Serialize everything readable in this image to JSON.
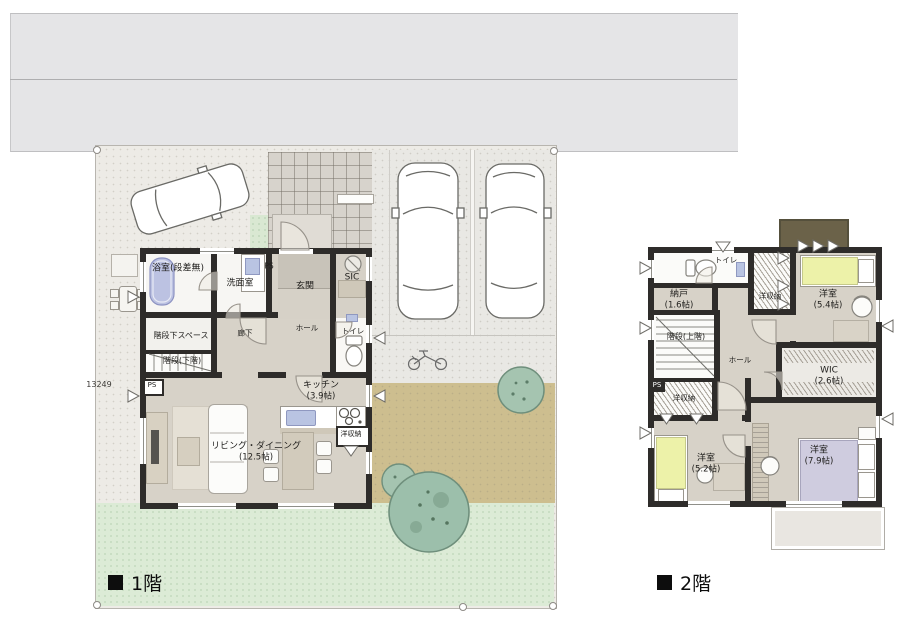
{
  "captions": {
    "floor1": "1階",
    "floor2": "2階"
  },
  "dimension": "13249",
  "f1": {
    "rooms": [
      {
        "name": "浴室(段差無)"
      },
      {
        "name": "洗面室"
      },
      {
        "name": "PS"
      },
      {
        "name": "玄関"
      },
      {
        "name": "SIC"
      },
      {
        "name": "ホール"
      },
      {
        "name": "トイレ"
      },
      {
        "name": "階段下スペース"
      },
      {
        "name": "階段(下階)"
      },
      {
        "name": "廊下"
      },
      {
        "name": "キッチン",
        "size": "(3.9帖)"
      },
      {
        "name": "リビング・ダイニング",
        "size": "(12.5帖)"
      },
      {
        "name": "洋収納"
      },
      {
        "name": "PS"
      }
    ]
  },
  "f2": {
    "rooms": [
      {
        "name": "トイレ"
      },
      {
        "name": "納戸",
        "size": "(1.6帖)"
      },
      {
        "name": "洋収納"
      },
      {
        "name": "洋室",
        "size": "(5.4帖)"
      },
      {
        "name": "階段(上階)"
      },
      {
        "name": "ホール"
      },
      {
        "name": "WIC",
        "size": "(2.6帖)"
      },
      {
        "name": "洋収納"
      },
      {
        "name": "洋室",
        "size": "(5.2帖)"
      },
      {
        "name": "洋室",
        "size": "(7.9帖)"
      },
      {
        "name": "PS"
      }
    ]
  },
  "colors": {
    "wall": "#2e2c2a",
    "floor": "#d7d2c8",
    "road": "#e5e5e7",
    "site": "#edebe6",
    "lawn": "#dcebd6",
    "dirt": "#cdbe8f",
    "tile": "#d7d3cc",
    "bathtub": "#bcc2e2",
    "sink": "#b9c4e2",
    "bed_yellow": "#edf2a9",
    "bed_purple": "#cfccdf",
    "tree": "#a5c4b0",
    "roof": "#6b6249",
    "balcony": "#e9e6e1"
  }
}
